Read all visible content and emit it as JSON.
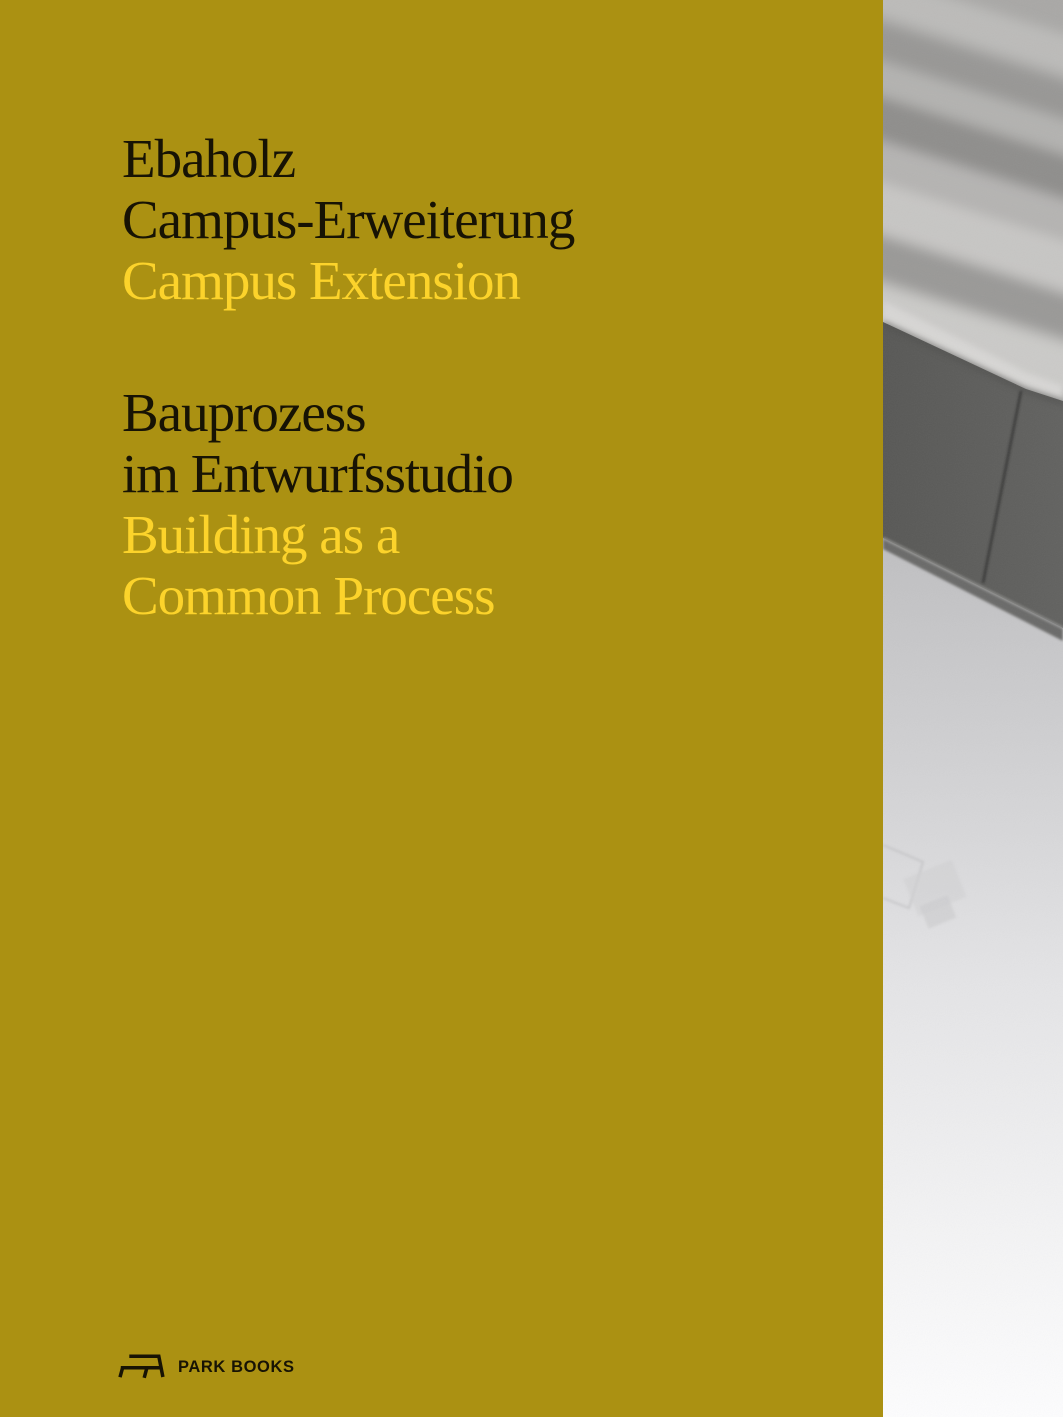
{
  "cover": {
    "colors": {
      "background": "#ab9112",
      "text_dark": "#171304",
      "text_yellow": "#fcd32b"
    },
    "title": {
      "german": [
        "Ebaholz",
        "Campus-Erweiterung"
      ],
      "english": [
        "Campus Extension"
      ]
    },
    "subtitle": {
      "german": [
        "Bauprozess",
        "im Entwurfsstudio"
      ],
      "english": [
        "Building as a",
        "Common Process"
      ]
    },
    "publisher": {
      "name": "PARK BOOKS",
      "logo_icon": "park-bench-icon"
    },
    "photo": {
      "description": "black-and-white photograph strip along the right edge: blurred light streaked surface above a dark grey box edge and a pale floor fading to white"
    }
  }
}
